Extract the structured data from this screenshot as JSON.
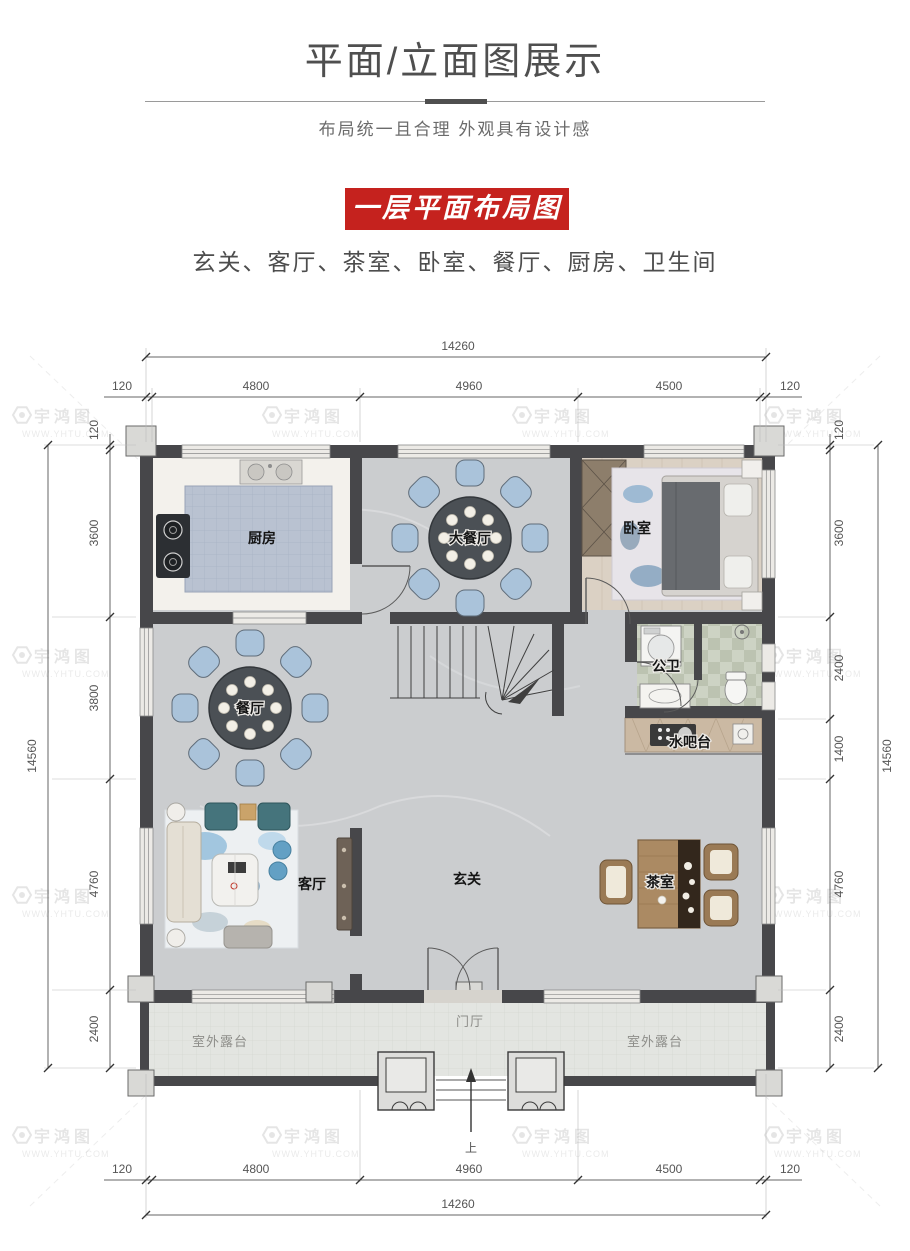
{
  "header": {
    "title": "平面/立面图展示",
    "subtitle": "布局统一且合理 外观具有设计感",
    "badge": "一层平面布局图",
    "room_list": "玄关、客厅、茶室、卧室、餐厅、厨房、卫生间"
  },
  "watermark": {
    "name": "宇鸿图",
    "url": "WWW.YHTU.COM"
  },
  "plan": {
    "rooms": {
      "kitchen": "厨房",
      "dining_large": "大餐厅",
      "bedroom": "卧室",
      "dining": "餐厅",
      "public_bath": "公卫",
      "water_bar": "水吧台",
      "living": "客厅",
      "foyer": "玄关",
      "tea_room": "茶室",
      "porch": "门厅",
      "terrace_left": "室外露台",
      "terrace_right": "室外露台",
      "stairs_up": "上"
    },
    "dimensions": {
      "top": {
        "total": "14260",
        "segments": [
          "120",
          "4800",
          "4960",
          "4500",
          "120"
        ]
      },
      "bottom": {
        "total": "14260",
        "segments": [
          "120",
          "4800",
          "4960",
          "4500",
          "120"
        ]
      },
      "left": {
        "total": "14560",
        "segments": [
          "120",
          "3600",
          "3800",
          "4760",
          "2400"
        ]
      },
      "right": {
        "total": "14560",
        "segments": [
          "120",
          "3600",
          "2400",
          "1400",
          "4760",
          "2400"
        ]
      }
    },
    "colors": {
      "badge_red": "#c5221e",
      "wall": "#47474a",
      "marble_floor": "#cbcdcf",
      "kitchen_tile": "#b9c2d1",
      "chair_blue": "#aac3da",
      "wood_floor": "#dbd1c4",
      "terrace": "#e3e5e1"
    }
  }
}
